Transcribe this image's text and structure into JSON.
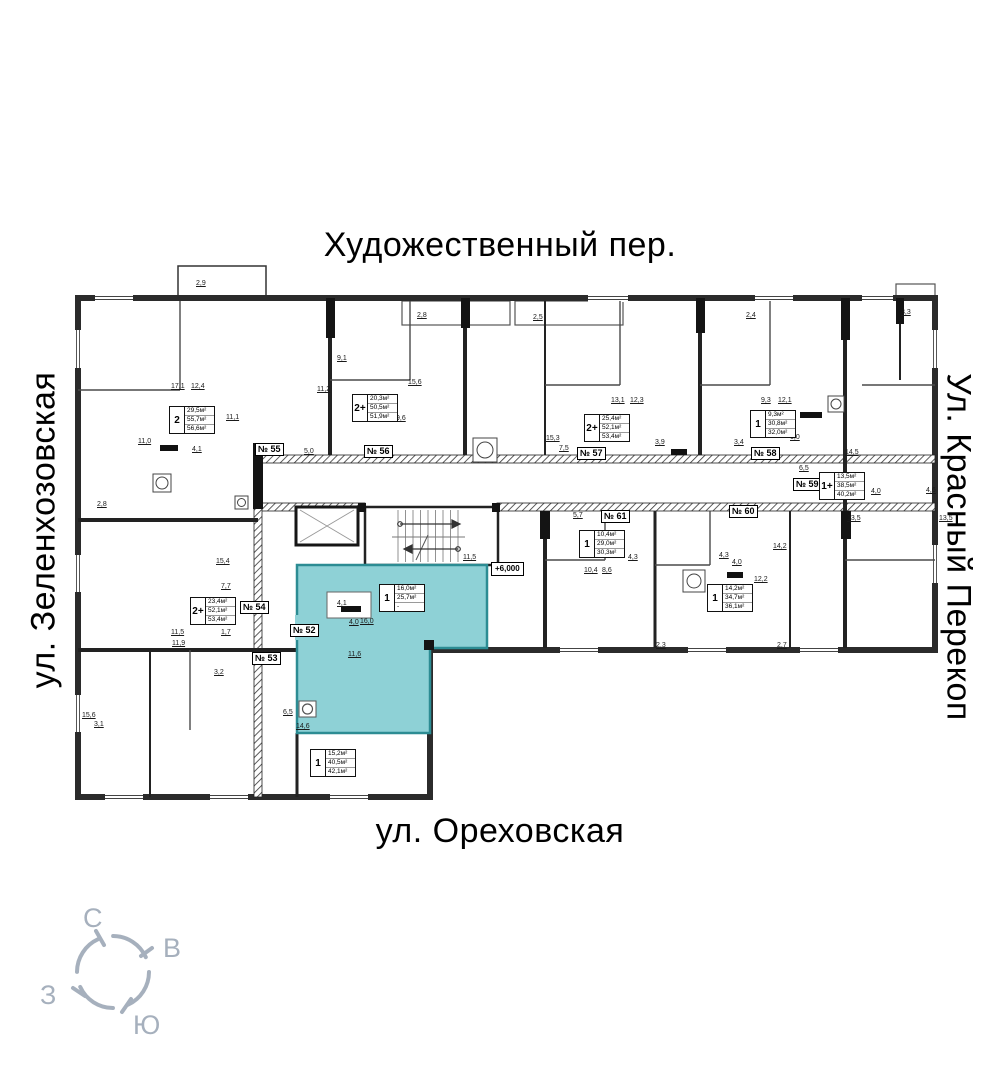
{
  "streets": {
    "top": "Художественный пер.",
    "left": "ул. Зеленхозовская",
    "right": "Ул. Красный Перекоп",
    "bottom": "ул. Ореховская"
  },
  "compass": {
    "north": "С",
    "east": "В",
    "west": "З",
    "south": "Ю"
  },
  "elevation_mark": "+6,000",
  "colors": {
    "highlight": "#8ed1d6",
    "highlight_border": "#2c8c93",
    "compass": "#a6b0bd"
  },
  "highlighted_unit": "№ 52",
  "apartment_labels": [
    {
      "type": "2",
      "areas": [
        "29,5м²",
        "55,7м²",
        "56,6м²"
      ],
      "x": 169,
      "y": 406,
      "highlight": false
    },
    {
      "type": "2+",
      "areas": [
        "20,3м²",
        "50,5м²",
        "51,9м²"
      ],
      "x": 352,
      "y": 394,
      "highlight": false
    },
    {
      "type": "2+",
      "areas": [
        "25,4м²",
        "52,1м²",
        "53,4м²"
      ],
      "x": 584,
      "y": 414,
      "highlight": false
    },
    {
      "type": "1",
      "areas": [
        "9,3м²",
        "30,8м²",
        "32,0м²"
      ],
      "x": 750,
      "y": 410,
      "highlight": false
    },
    {
      "type": "1+",
      "areas": [
        "13,5м²",
        "38,5м²",
        "40,2м²"
      ],
      "x": 819,
      "y": 472,
      "highlight": false
    },
    {
      "type": "1",
      "areas": [
        "10,4м²",
        "29,0м²",
        "30,3м²"
      ],
      "x": 579,
      "y": 530,
      "highlight": false
    },
    {
      "type": "1",
      "areas": [
        "14,2м²",
        "34,7м²",
        "36,1м²"
      ],
      "x": 707,
      "y": 584,
      "highlight": false
    },
    {
      "type": "2+",
      "areas": [
        "23,4м²",
        "52,1м²",
        "53,4м²"
      ],
      "x": 190,
      "y": 597,
      "highlight": false
    },
    {
      "type": "1",
      "areas": [
        "16,0м²",
        "25,7м²",
        "-"
      ],
      "x": 379,
      "y": 584,
      "highlight": true
    },
    {
      "type": "1",
      "areas": [
        "15,2м²",
        "40,5м²",
        "42,1м²"
      ],
      "x": 310,
      "y": 749,
      "highlight": false
    }
  ],
  "unit_tags": [
    {
      "label": "№ 55",
      "x": 255,
      "y": 443
    },
    {
      "label": "№ 56",
      "x": 364,
      "y": 445
    },
    {
      "label": "№ 57",
      "x": 577,
      "y": 447
    },
    {
      "label": "№ 58",
      "x": 751,
      "y": 447
    },
    {
      "label": "№ 59",
      "x": 793,
      "y": 478
    },
    {
      "label": "№ 61",
      "x": 601,
      "y": 510
    },
    {
      "label": "№ 60",
      "x": 729,
      "y": 505
    },
    {
      "label": "№ 54",
      "x": 240,
      "y": 601
    },
    {
      "label": "№ 52",
      "x": 290,
      "y": 624
    },
    {
      "label": "№ 53",
      "x": 252,
      "y": 652
    }
  ],
  "dimensions": [
    {
      "t": "2,9",
      "x": 196,
      "y": 280
    },
    {
      "t": "17,1",
      "x": 171,
      "y": 383
    },
    {
      "t": "12,4",
      "x": 191,
      "y": 383
    },
    {
      "t": "11,1",
      "x": 226,
      "y": 414
    },
    {
      "t": "4,1",
      "x": 192,
      "y": 446
    },
    {
      "t": "5,0",
      "x": 304,
      "y": 448
    },
    {
      "t": "11,2",
      "x": 317,
      "y": 386
    },
    {
      "t": "9,1",
      "x": 337,
      "y": 355
    },
    {
      "t": "15,6",
      "x": 408,
      "y": 379
    },
    {
      "t": "9,6",
      "x": 396,
      "y": 415
    },
    {
      "t": "2,8",
      "x": 417,
      "y": 312
    },
    {
      "t": "2,5",
      "x": 533,
      "y": 314
    },
    {
      "t": "15,3",
      "x": 546,
      "y": 435
    },
    {
      "t": "13,1",
      "x": 611,
      "y": 397
    },
    {
      "t": "12,3",
      "x": 630,
      "y": 397
    },
    {
      "t": "3,9",
      "x": 655,
      "y": 439
    },
    {
      "t": "7,5",
      "x": 559,
      "y": 445
    },
    {
      "t": "9,3",
      "x": 761,
      "y": 397
    },
    {
      "t": "12,1",
      "x": 778,
      "y": 397
    },
    {
      "t": "3,4",
      "x": 734,
      "y": 439
    },
    {
      "t": "6,0",
      "x": 790,
      "y": 434
    },
    {
      "t": "6,5",
      "x": 799,
      "y": 465
    },
    {
      "t": "14,5",
      "x": 845,
      "y": 449
    },
    {
      "t": "4,0",
      "x": 871,
      "y": 488
    },
    {
      "t": "13,5",
      "x": 847,
      "y": 515
    },
    {
      "t": "4,6",
      "x": 926,
      "y": 487
    },
    {
      "t": "13,5",
      "x": 939,
      "y": 515
    },
    {
      "t": "3,3",
      "x": 901,
      "y": 309
    },
    {
      "t": "2,4",
      "x": 746,
      "y": 312
    },
    {
      "t": "5,7",
      "x": 573,
      "y": 512
    },
    {
      "t": "10,4",
      "x": 584,
      "y": 567
    },
    {
      "t": "8,6",
      "x": 602,
      "y": 567
    },
    {
      "t": "4,3",
      "x": 628,
      "y": 554
    },
    {
      "t": "4,3",
      "x": 719,
      "y": 552
    },
    {
      "t": "4,0",
      "x": 732,
      "y": 559
    },
    {
      "t": "14,2",
      "x": 773,
      "y": 543
    },
    {
      "t": "12,2",
      "x": 754,
      "y": 576
    },
    {
      "t": "2,7",
      "x": 777,
      "y": 642
    },
    {
      "t": "2,3",
      "x": 656,
      "y": 642
    },
    {
      "t": "15,4",
      "x": 216,
      "y": 558
    },
    {
      "t": "7,7",
      "x": 221,
      "y": 583
    },
    {
      "t": "11,5",
      "x": 171,
      "y": 629
    },
    {
      "t": "11,9",
      "x": 172,
      "y": 640
    },
    {
      "t": "1,7",
      "x": 221,
      "y": 629
    },
    {
      "t": "3,2",
      "x": 214,
      "y": 669
    },
    {
      "t": "3,1",
      "x": 94,
      "y": 721
    },
    {
      "t": "11,0",
      "x": 138,
      "y": 438
    },
    {
      "t": "2,8",
      "x": 97,
      "y": 501
    },
    {
      "t": "15,6",
      "x": 82,
      "y": 712
    },
    {
      "t": "4,1",
      "x": 337,
      "y": 600
    },
    {
      "t": "4,0",
      "x": 349,
      "y": 619
    },
    {
      "t": "16,0",
      "x": 360,
      "y": 618
    },
    {
      "t": "11,6",
      "x": 348,
      "y": 651
    },
    {
      "t": "6,5",
      "x": 283,
      "y": 709
    },
    {
      "t": "14,6",
      "x": 296,
      "y": 723
    },
    {
      "t": "11,5",
      "x": 463,
      "y": 554
    }
  ]
}
